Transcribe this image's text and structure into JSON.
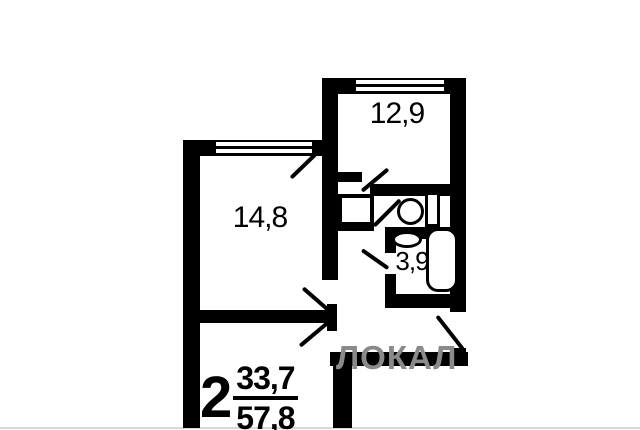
{
  "plan": {
    "rooms": [
      {
        "area_label": "12,9"
      },
      {
        "area_label": "14,8"
      },
      {
        "area_label": "3,9"
      }
    ],
    "stamp": {
      "room_count": "2",
      "living_area": "33,7",
      "total_area": "57,8"
    },
    "watermark": "ЛОКАЛ",
    "colors": {
      "wall": "#000000",
      "background": "#ffffff",
      "watermark": "#8a8a8a",
      "bottom_rule": "#d8d8d8"
    }
  }
}
